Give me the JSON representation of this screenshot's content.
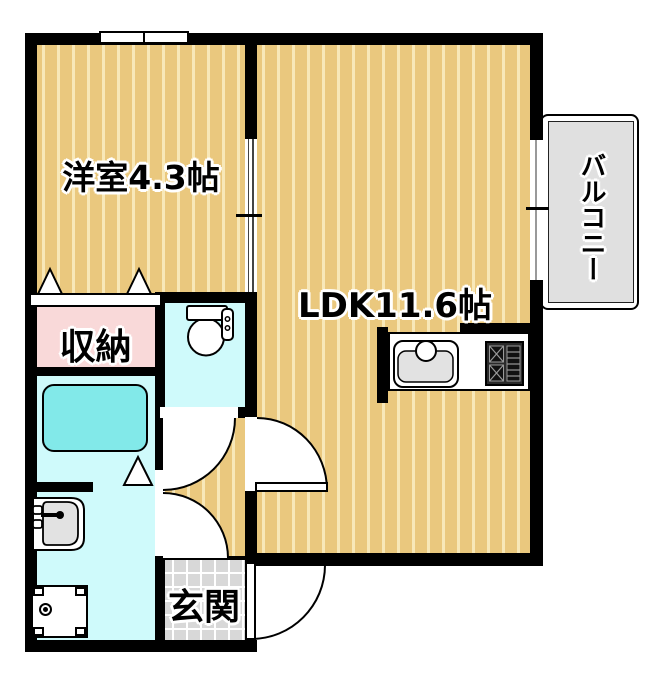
{
  "floorplan": {
    "rooms": {
      "western_room": "洋室4.3帖",
      "ldk": "LDK11.6帖",
      "storage": "収納",
      "entrance": "玄関",
      "balcony": "バルコニー"
    },
    "fixtures": [
      "toilet-icon",
      "bathtub-icon",
      "washbasin-icon",
      "washing-machine-icon",
      "kitchen-sink-icon",
      "stove-icon",
      "sliding-door-icon",
      "window-icon",
      "door-swing-icon",
      "folding-door-triangle-icon"
    ],
    "colors": {
      "floor_tan": "#EAC87E",
      "floor_stripe": "#F8E8B8",
      "wall": "#000000",
      "storage_pink": "#F9D9D9",
      "wet_area_cyan": "#CFFAFB",
      "bathtub_cyan": "#82E9E9",
      "entrance_tile": "#D8D8D8",
      "balcony_gray": "#E0E0E0"
    }
  }
}
